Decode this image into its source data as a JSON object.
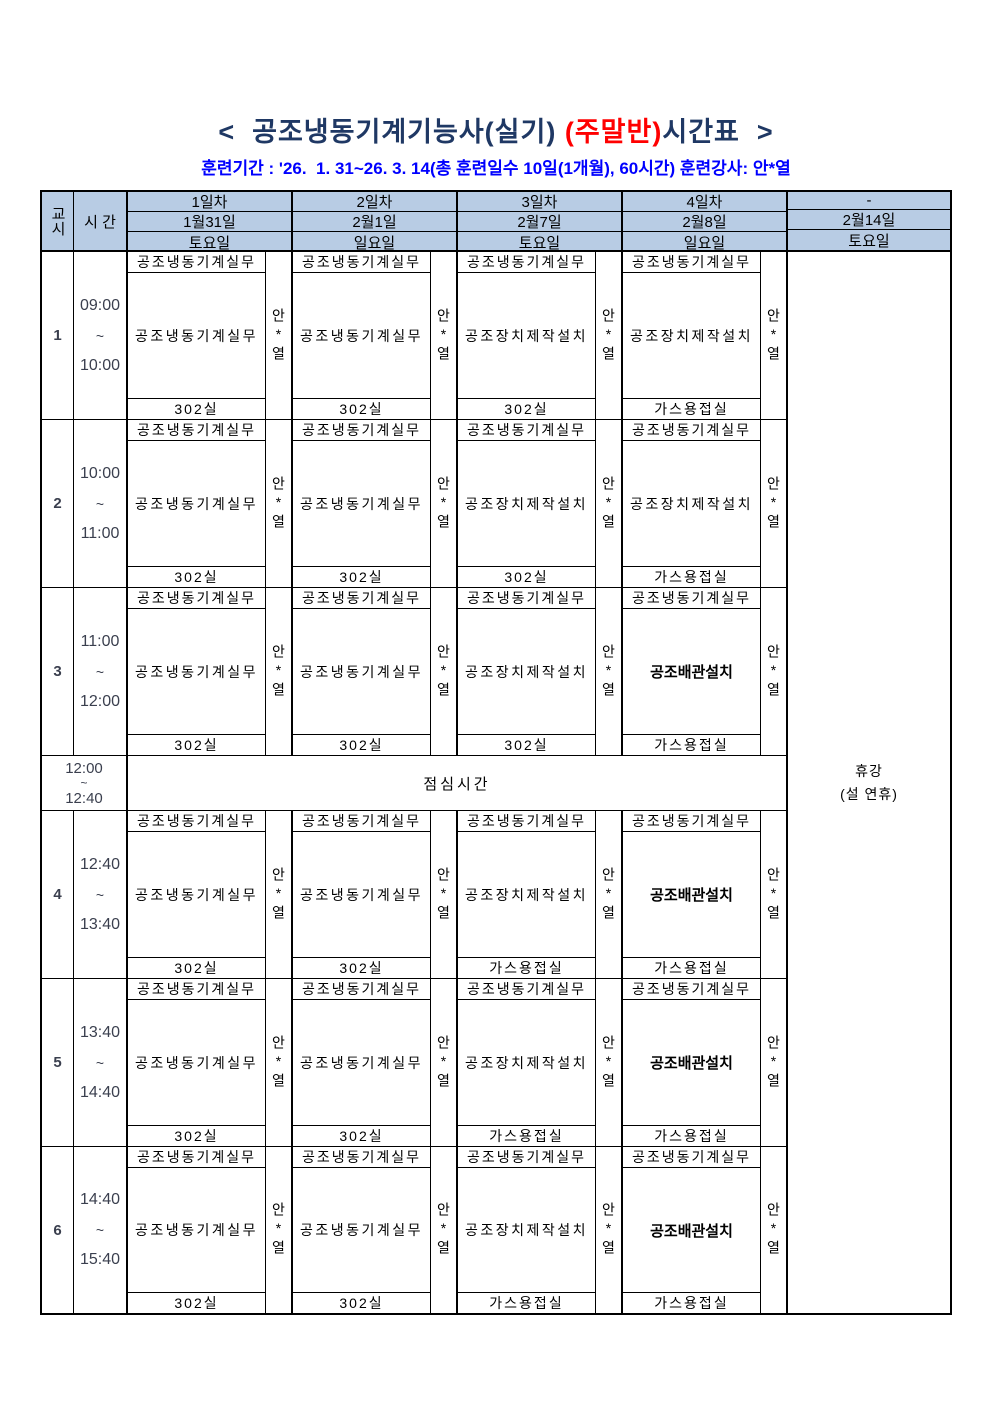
{
  "title": {
    "prefix": "<  공조냉동기계기능사(실기) ",
    "highlight": "(주말반)",
    "suffix": "시간표  >"
  },
  "subtitle": "훈련기간 : '26.  1. 31~26. 3. 14(총 훈련일수 10일(1개월), 60시간) 훈련강사: 안*열",
  "colors": {
    "header_bg": "#B8CCE4",
    "title_navy": "#1F3864",
    "subtitle_blue": "#0000FF",
    "highlight_red": "#FF0000",
    "border": "#000000"
  },
  "header": {
    "period_col": "교시",
    "time_col": "시 간",
    "days": [
      {
        "label": "1일차",
        "date": "1월31일",
        "weekday": "토요일"
      },
      {
        "label": "2일차",
        "date": "2월1일",
        "weekday": "일요일"
      },
      {
        "label": "3일차",
        "date": "2월7일",
        "weekday": "토요일"
      },
      {
        "label": "4일차",
        "date": "2월8일",
        "weekday": "일요일"
      },
      {
        "label": "-",
        "date": "2월14일",
        "weekday": "토요일"
      }
    ]
  },
  "labels": {
    "tilde": "~",
    "lunch": "점심시간",
    "holiday_line1": "휴강",
    "holiday_line2": "(설 연휴)"
  },
  "lunch": {
    "start": "12:00",
    "end": "12:40"
  },
  "periods": [
    {
      "no": "1",
      "start": "09:00",
      "end": "10:00",
      "days": [
        {
          "title": "공조냉동기계실무",
          "content": "공조냉동기계실무",
          "room": "302실",
          "instructor": "안*열"
        },
        {
          "title": "공조냉동기계실무",
          "content": "공조냉동기계실무",
          "room": "302실",
          "instructor": "안*열"
        },
        {
          "title": "공조냉동기계실무",
          "content": "공조장치제작설치",
          "room": "302실",
          "instructor": "안*열"
        },
        {
          "title": "공조냉동기계실무",
          "content": "공조장치제작설치",
          "room": "가스용접실",
          "instructor": "안*열"
        }
      ]
    },
    {
      "no": "2",
      "start": "10:00",
      "end": "11:00",
      "days": [
        {
          "title": "공조냉동기계실무",
          "content": "공조냉동기계실무",
          "room": "302실",
          "instructor": "안*열"
        },
        {
          "title": "공조냉동기계실무",
          "content": "공조냉동기계실무",
          "room": "302실",
          "instructor": "안*열"
        },
        {
          "title": "공조냉동기계실무",
          "content": "공조장치제작설치",
          "room": "302실",
          "instructor": "안*열"
        },
        {
          "title": "공조냉동기계실무",
          "content": "공조장치제작설치",
          "room": "가스용접실",
          "instructor": "안*열"
        }
      ]
    },
    {
      "no": "3",
      "start": "11:00",
      "end": "12:00",
      "days": [
        {
          "title": "공조냉동기계실무",
          "content": "공조냉동기계실무",
          "room": "302실",
          "instructor": "안*열"
        },
        {
          "title": "공조냉동기계실무",
          "content": "공조냉동기계실무",
          "room": "302실",
          "instructor": "안*열"
        },
        {
          "title": "공조냉동기계실무",
          "content": "공조장치제작설치",
          "room": "302실",
          "instructor": "안*열"
        },
        {
          "title": "공조냉동기계실무",
          "content": "공조배관설치",
          "room": "가스용접실",
          "instructor": "안*열",
          "variant": "tight"
        }
      ]
    },
    {
      "no": "4",
      "start": "12:40",
      "end": "13:40",
      "days": [
        {
          "title": "공조냉동기계실무",
          "content": "공조냉동기계실무",
          "room": "302실",
          "instructor": "안*열"
        },
        {
          "title": "공조냉동기계실무",
          "content": "공조냉동기계실무",
          "room": "302실",
          "instructor": "안*열"
        },
        {
          "title": "공조냉동기계실무",
          "content": "공조장치제작설치",
          "room": "가스용접실",
          "instructor": "안*열"
        },
        {
          "title": "공조냉동기계실무",
          "content": "공조배관설치",
          "room": "가스용접실",
          "instructor": "안*열",
          "variant": "tight"
        }
      ]
    },
    {
      "no": "5",
      "start": "13:40",
      "end": "14:40",
      "days": [
        {
          "title": "공조냉동기계실무",
          "content": "공조냉동기계실무",
          "room": "302실",
          "instructor": "안*열"
        },
        {
          "title": "공조냉동기계실무",
          "content": "공조냉동기계실무",
          "room": "302실",
          "instructor": "안*열"
        },
        {
          "title": "공조냉동기계실무",
          "content": "공조장치제작설치",
          "room": "가스용접실",
          "instructor": "안*열"
        },
        {
          "title": "공조냉동기계실무",
          "content": "공조배관설치",
          "room": "가스용접실",
          "instructor": "안*열",
          "variant": "tight"
        }
      ]
    },
    {
      "no": "6",
      "start": "14:40",
      "end": "15:40",
      "days": [
        {
          "title": "공조냉동기계실무",
          "content": "공조냉동기계실무",
          "room": "302실",
          "instructor": "안*열"
        },
        {
          "title": "공조냉동기계실무",
          "content": "공조냉동기계실무",
          "room": "302실",
          "instructor": "안*열"
        },
        {
          "title": "공조냉동기계실무",
          "content": "공조장치제작설치",
          "room": "가스용접실",
          "instructor": "안*열"
        },
        {
          "title": "공조냉동기계실무",
          "content": "공조배관설치",
          "room": "가스용접실",
          "instructor": "안*열",
          "variant": "tight"
        }
      ]
    }
  ]
}
